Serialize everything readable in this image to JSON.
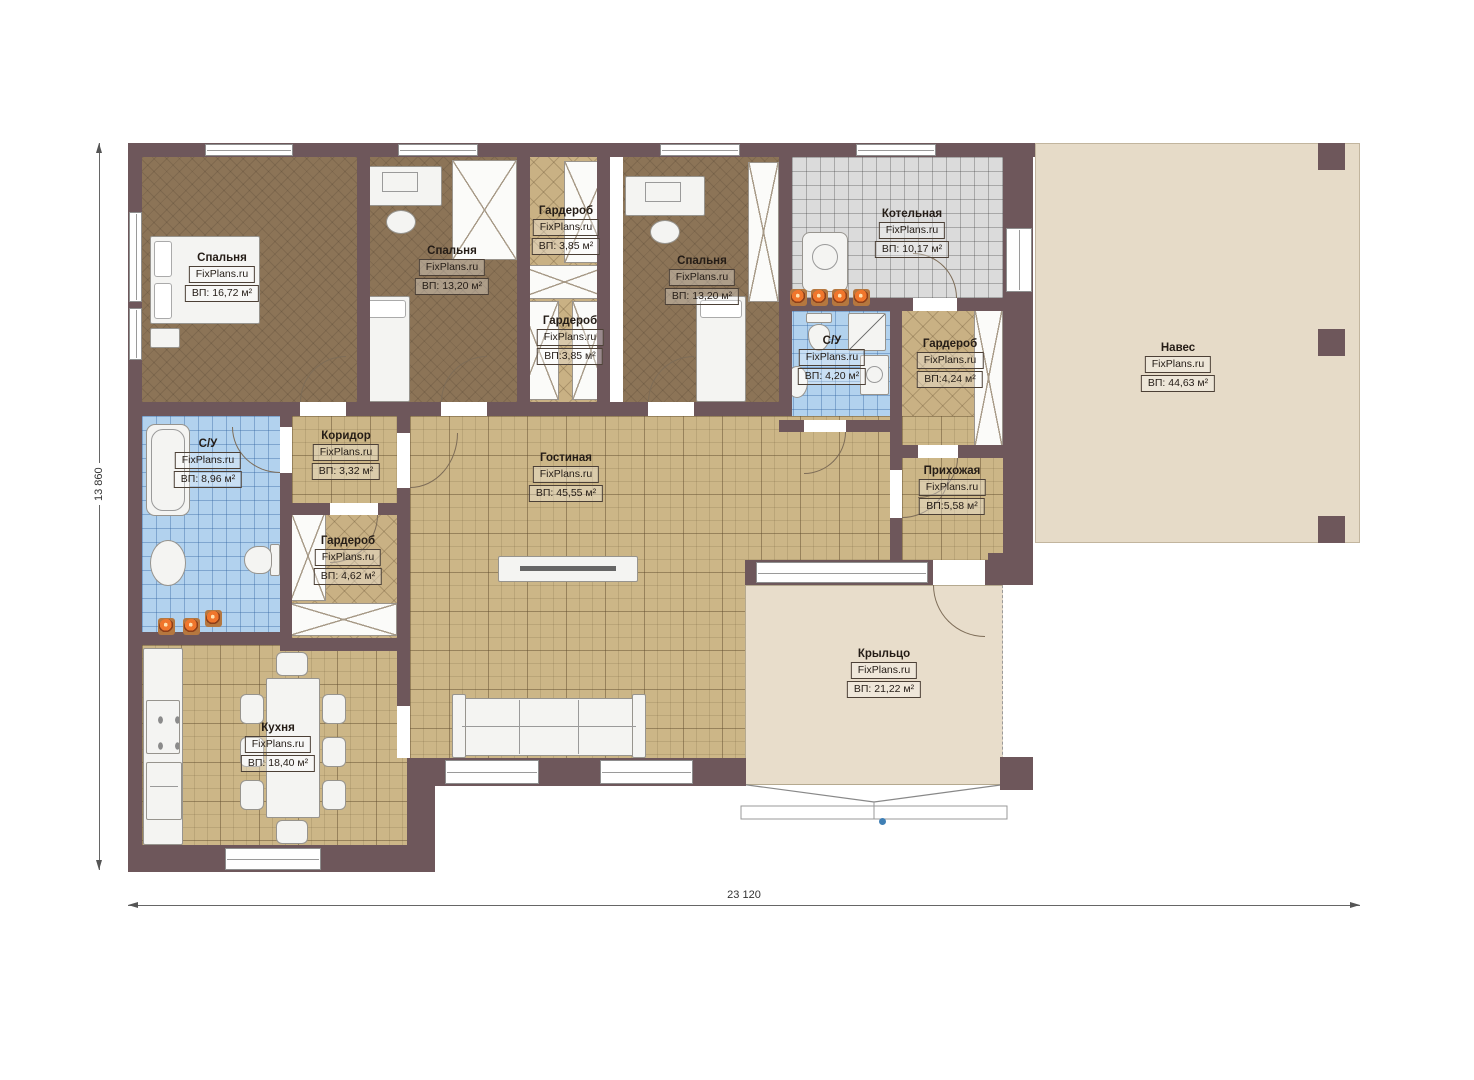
{
  "plan": {
    "type": "floor-plan",
    "brand": "FixPlans.ru",
    "dimensions": {
      "width_label": "23 120",
      "height_label": "13 860"
    },
    "colors": {
      "wall": "#6e575b",
      "bedroom_floor": "#8c7457",
      "tile_tan": "#ccb687",
      "tile_gray": "#dbdbdb",
      "tile_blue": "#b2d2ee",
      "outdoor_beige": "#e6dbc8",
      "spotlight_orange": "#f0762c"
    }
  },
  "rooms": [
    {
      "id": "bedroom-1",
      "name": "Спальня",
      "brand": "FixPlans.ru",
      "area": "ВП: 16,72 м²"
    },
    {
      "id": "bedroom-2",
      "name": "Спальня",
      "brand": "FixPlans.ru",
      "area": "ВП: 13,20 м²"
    },
    {
      "id": "wardrobe-top",
      "name": "Гардероб",
      "brand": "FixPlans.ru",
      "area": "ВП: 3,85 м²"
    },
    {
      "id": "wardrobe-mid",
      "name": "Гардероб",
      "brand": "FixPlans.ru",
      "area": "ВП:3,85 м²"
    },
    {
      "id": "bedroom-3",
      "name": "Спальня",
      "brand": "FixPlans.ru",
      "area": "ВП: 13,20 м²"
    },
    {
      "id": "boiler-room",
      "name": "Котельная",
      "brand": "FixPlans.ru",
      "area": "ВП: 10,17 м²"
    },
    {
      "id": "bathroom-small",
      "name": "С/У",
      "brand": "FixPlans.ru",
      "area": "ВП: 4,20 м²"
    },
    {
      "id": "wardrobe-right",
      "name": "Гардероб",
      "brand": "FixPlans.ru",
      "area": "ВП:4,24 м²"
    },
    {
      "id": "canopy",
      "name": "Навес",
      "brand": "FixPlans.ru",
      "area": "ВП: 44,63 м²"
    },
    {
      "id": "bathroom-big",
      "name": "С/У",
      "brand": "FixPlans.ru",
      "area": "ВП: 8,96 м²"
    },
    {
      "id": "corridor",
      "name": "Коридор",
      "brand": "FixPlans.ru",
      "area": "ВП: 3,32 м²"
    },
    {
      "id": "living-room",
      "name": "Гостиная",
      "brand": "FixPlans.ru",
      "area": "ВП: 45,55 м²"
    },
    {
      "id": "hallway",
      "name": "Прихожая",
      "brand": "FixPlans.ru",
      "area": "ВП:5,58 м²"
    },
    {
      "id": "wardrobe-low",
      "name": "Гардероб",
      "brand": "FixPlans.ru",
      "area": "ВП: 4,62 м²"
    },
    {
      "id": "kitchen",
      "name": "Кухня",
      "brand": "FixPlans.ru",
      "area": "ВП: 18,40 м²"
    },
    {
      "id": "porch",
      "name": "Крыльцо",
      "brand": "FixPlans.ru",
      "area": "ВП: 21,22 м²"
    }
  ]
}
